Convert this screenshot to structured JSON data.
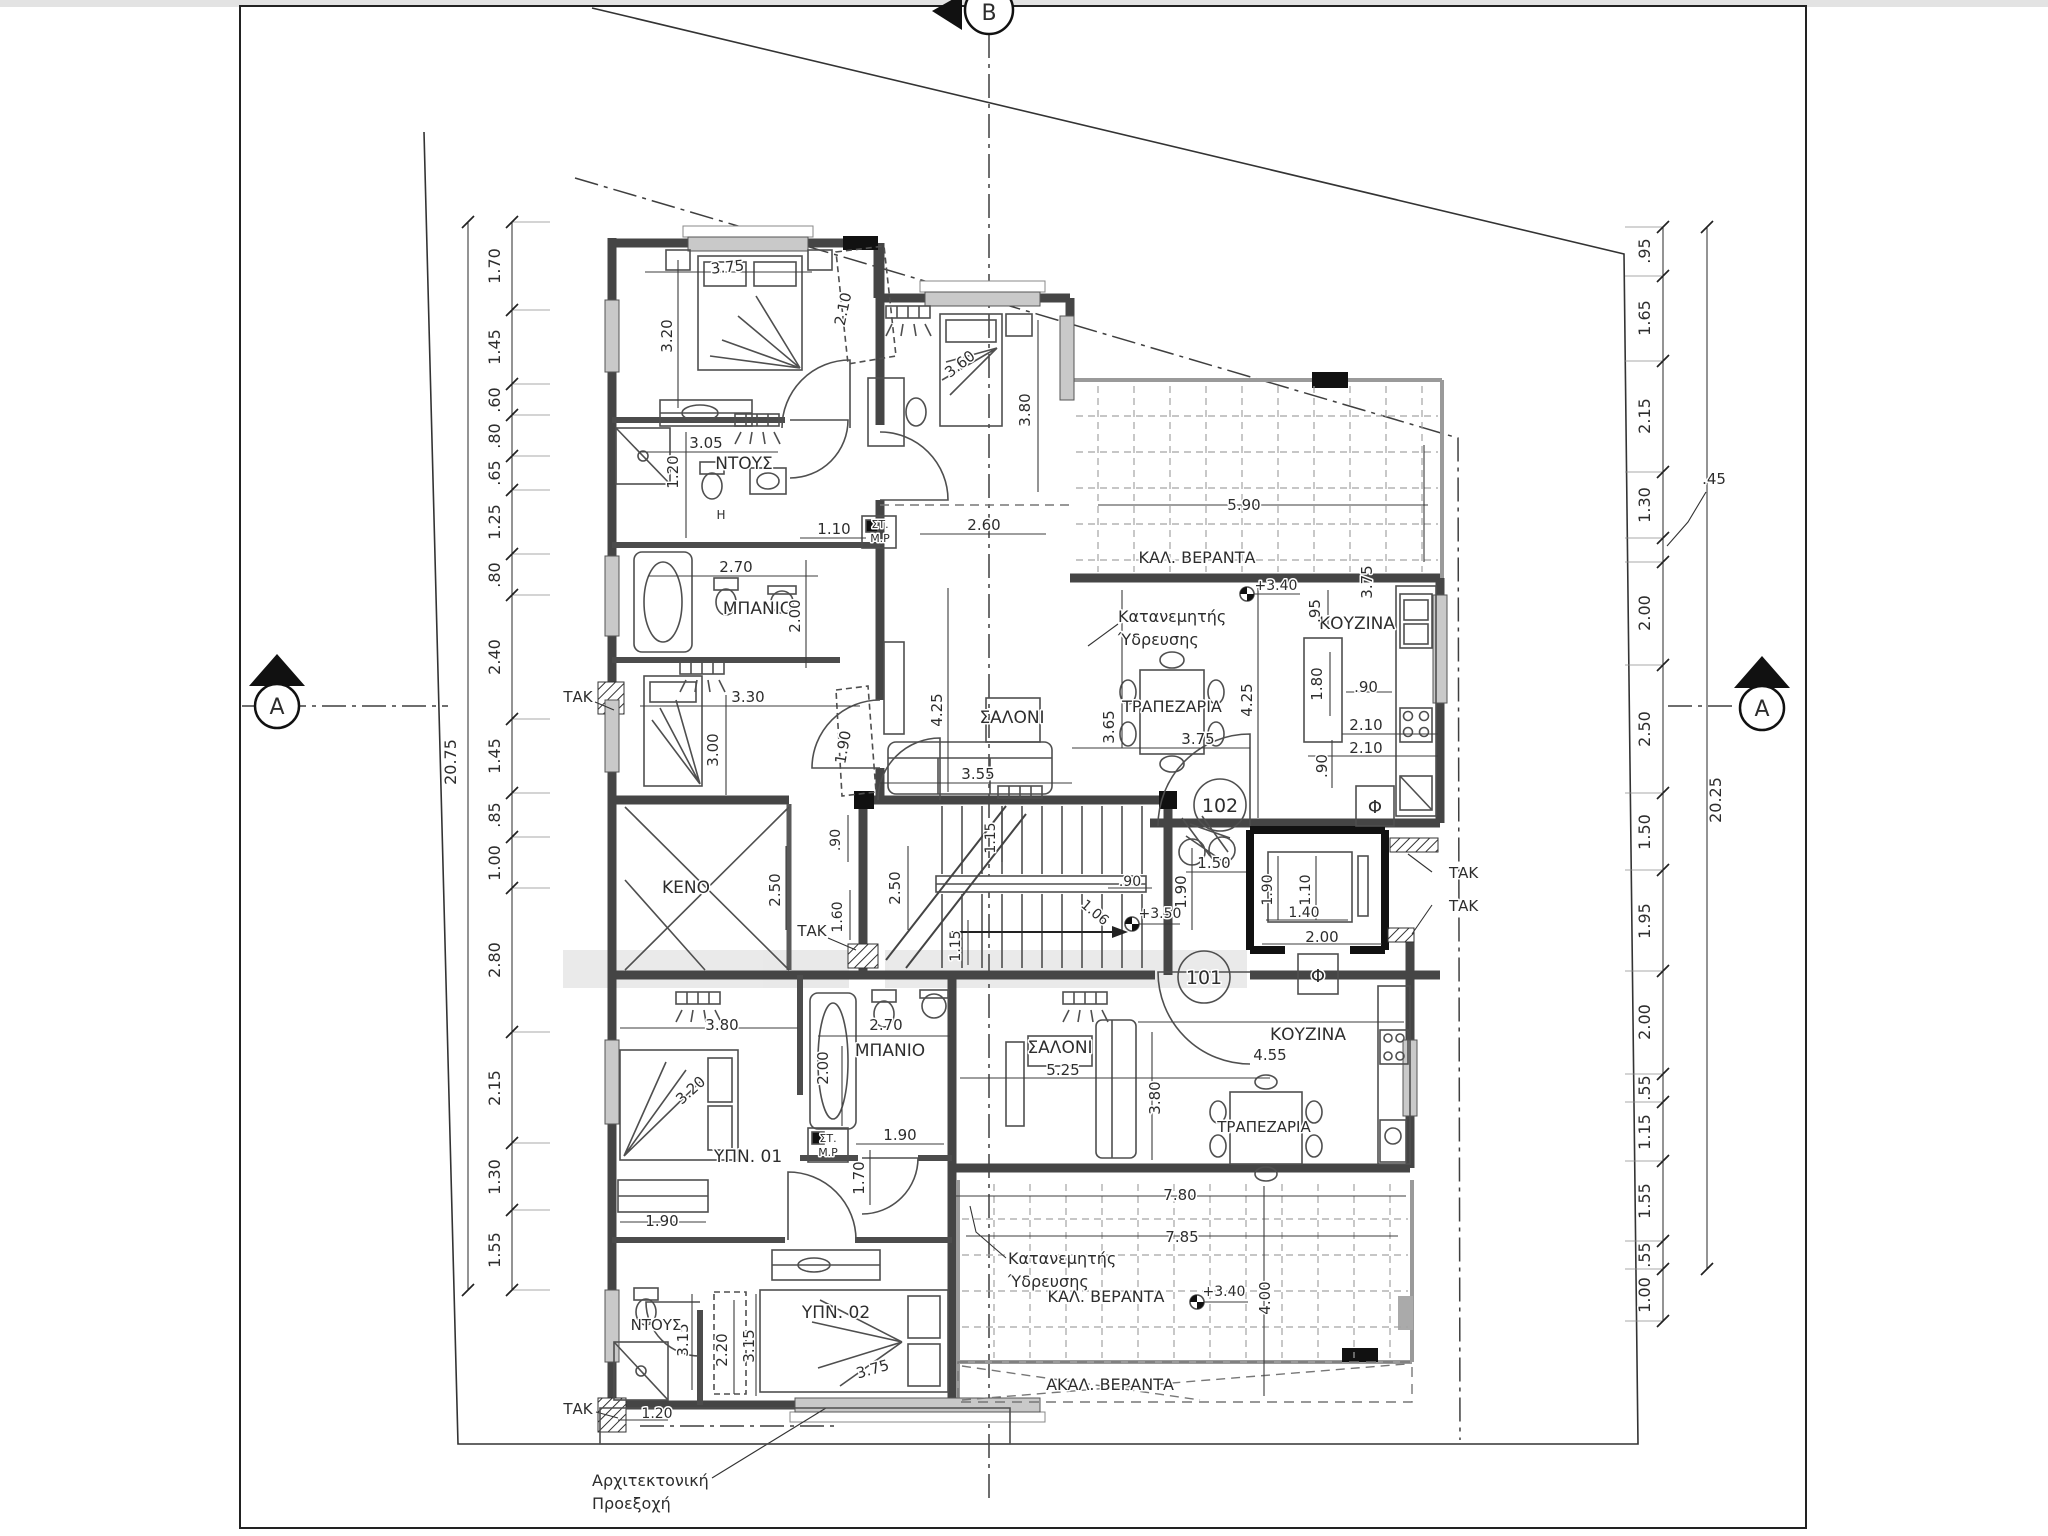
{
  "drawing_type": "architectural-floor-plan",
  "section_markers": {
    "top": "B",
    "left": "A",
    "right": "A"
  },
  "apartment_numbers": {
    "upper": "102",
    "lower": "101"
  },
  "colors": {
    "wall": "#454545",
    "black_column": "#111111",
    "text": "#2d2d2d",
    "window": "#c9c9c9",
    "paper": "#ffffff"
  },
  "overall_dims": {
    "left_total": "20.75",
    "right_total": "20.25"
  },
  "texts": [
    {
      "n": "dim-total-left",
      "t": "20.75",
      "x": 456,
      "y": 762,
      "r": -90,
      "s": 16
    },
    {
      "n": "dim-chain-left-1",
      "t": "1.70",
      "x": 500,
      "y": 266,
      "r": -90,
      "s": 16
    },
    {
      "n": "dim-chain-left-2",
      "t": "1.45",
      "x": 500,
      "y": 347,
      "r": -90,
      "s": 16
    },
    {
      "n": "dim-chain-left-3",
      "t": ".60",
      "x": 500,
      "y": 400,
      "r": -90,
      "s": 16
    },
    {
      "n": "dim-chain-left-4",
      "t": ".80",
      "x": 500,
      "y": 436,
      "r": -90,
      "s": 16
    },
    {
      "n": "dim-chain-left-5",
      "t": ".65",
      "x": 500,
      "y": 473,
      "r": -90,
      "s": 16
    },
    {
      "n": "dim-chain-left-6",
      "t": "1.25",
      "x": 500,
      "y": 522,
      "r": -90,
      "s": 16
    },
    {
      "n": "dim-chain-left-7",
      "t": ".80",
      "x": 500,
      "y": 575,
      "r": -90,
      "s": 16
    },
    {
      "n": "dim-chain-left-8",
      "t": "2.40",
      "x": 500,
      "y": 657,
      "r": -90,
      "s": 16
    },
    {
      "n": "dim-chain-left-9",
      "t": "1.45",
      "x": 500,
      "y": 756,
      "r": -90,
      "s": 16
    },
    {
      "n": "dim-chain-left-10",
      "t": ".85",
      "x": 500,
      "y": 815,
      "r": -90,
      "s": 16
    },
    {
      "n": "dim-chain-left-11",
      "t": "1.00",
      "x": 500,
      "y": 863,
      "r": -90,
      "s": 16
    },
    {
      "n": "dim-chain-left-12",
      "t": "2.80",
      "x": 500,
      "y": 960,
      "r": -90,
      "s": 16
    },
    {
      "n": "dim-chain-left-13",
      "t": "2.15",
      "x": 500,
      "y": 1088,
      "r": -90,
      "s": 16
    },
    {
      "n": "dim-chain-left-14",
      "t": "1.30",
      "x": 500,
      "y": 1177,
      "r": -90,
      "s": 16
    },
    {
      "n": "dim-chain-left-15",
      "t": "1.55",
      "x": 500,
      "y": 1250,
      "r": -90,
      "s": 16
    },
    {
      "n": "dim-total-right",
      "t": "20.25",
      "x": 1721,
      "y": 800,
      "r": -90,
      "s": 16
    },
    {
      "n": "dim-chain-right-1",
      "t": ".95",
      "x": 1650,
      "y": 251,
      "r": -90,
      "s": 16
    },
    {
      "n": "dim-chain-right-2",
      "t": "1.65",
      "x": 1650,
      "y": 318,
      "r": -90,
      "s": 16
    },
    {
      "n": "dim-chain-right-3",
      "t": "2.15",
      "x": 1650,
      "y": 416,
      "r": -90,
      "s": 16
    },
    {
      "n": "dim-chain-right-4",
      "t": "1.30",
      "x": 1650,
      "y": 505,
      "r": -90,
      "s": 16
    },
    {
      "n": "dim-chain-right-5",
      "t": ".45",
      "x": 1714,
      "y": 484,
      "r": 0,
      "s": 15
    },
    {
      "n": "dim-chain-right-6",
      "t": "2.00",
      "x": 1650,
      "y": 613,
      "r": -90,
      "s": 16
    },
    {
      "n": "dim-chain-right-7",
      "t": "2.50",
      "x": 1650,
      "y": 729,
      "r": -90,
      "s": 16
    },
    {
      "n": "dim-chain-right-8",
      "t": "1.50",
      "x": 1650,
      "y": 832,
      "r": -90,
      "s": 16
    },
    {
      "n": "dim-chain-right-9",
      "t": "1.95",
      "x": 1650,
      "y": 921,
      "r": -90,
      "s": 16
    },
    {
      "n": "dim-chain-right-10",
      "t": "2.00",
      "x": 1650,
      "y": 1022,
      "r": -90,
      "s": 16
    },
    {
      "n": "dim-chain-right-11",
      "t": ".55",
      "x": 1650,
      "y": 1088,
      "r": -90,
      "s": 16
    },
    {
      "n": "dim-chain-right-12",
      "t": "1.15",
      "x": 1650,
      "y": 1132,
      "r": -90,
      "s": 16
    },
    {
      "n": "dim-chain-right-13",
      "t": "1.55",
      "x": 1650,
      "y": 1201,
      "r": -90,
      "s": 16
    },
    {
      "n": "dim-chain-right-14",
      "t": ".55",
      "x": 1650,
      "y": 1255,
      "r": -90,
      "s": 16
    },
    {
      "n": "dim-chain-right-15",
      "t": "1.00",
      "x": 1650,
      "y": 1295,
      "r": -90,
      "s": 16
    },
    {
      "n": "room-label-shower-102",
      "t": "ΝΤΟΥΣ",
      "x": 744,
      "y": 469,
      "r": 0,
      "s": 17
    },
    {
      "n": "dim-shower-width",
      "t": "3.05",
      "x": 706,
      "y": 448,
      "r": 0,
      "s": 15
    },
    {
      "n": "dim-shower-depth",
      "t": "1.20",
      "x": 678,
      "y": 472,
      "r": -90,
      "s": 15
    },
    {
      "n": "label-h-boiler",
      "t": "H",
      "x": 721,
      "y": 519,
      "r": 0,
      "s": 12
    },
    {
      "n": "room-label-bath-102",
      "t": "ΜΠΑΝΙΟ",
      "x": 758,
      "y": 614,
      "r": 0,
      "s": 17
    },
    {
      "n": "dim-bath102-width",
      "t": "2.70",
      "x": 736,
      "y": 572,
      "r": 0,
      "s": 15
    },
    {
      "n": "dim-bath102-depth",
      "t": "2.00",
      "x": 800,
      "y": 616,
      "r": -90,
      "s": 15
    },
    {
      "n": "dim-bed1-width",
      "t": "3.75",
      "x": 728,
      "y": 272,
      "r": -6,
      "s": 15
    },
    {
      "n": "dim-bed1-height",
      "t": "3.20",
      "x": 672,
      "y": 336,
      "r": -90,
      "s": 15
    },
    {
      "n": "dim-bed1-wardrobe",
      "t": "2.10",
      "x": 848,
      "y": 310,
      "r": -78,
      "s": 15
    },
    {
      "n": "dim-bed2-diag",
      "t": "3.60",
      "x": 963,
      "y": 368,
      "r": -38,
      "s": 15
    },
    {
      "n": "dim-bed2-height",
      "t": "3.80",
      "x": 1030,
      "y": 410,
      "r": -90,
      "s": 15
    },
    {
      "n": "dim-bed3-width",
      "t": "3.30",
      "x": 748,
      "y": 702,
      "r": 0,
      "s": 15
    },
    {
      "n": "dim-bed3-height",
      "t": "3.00",
      "x": 718,
      "y": 750,
      "r": -90,
      "s": 15
    },
    {
      "n": "dim-bed3-wardrobe",
      "t": "1.90",
      "x": 848,
      "y": 748,
      "r": -80,
      "s": 15
    },
    {
      "n": "dim-corridor-110",
      "t": "1.10",
      "x": 834,
      "y": 534,
      "r": 0,
      "s": 15
    },
    {
      "n": "dim-corridor-260",
      "t": "2.60",
      "x": 984,
      "y": 530,
      "r": 0,
      "s": 15
    },
    {
      "n": "label-st-box-up",
      "t": "ΣΤ.",
      "x": 880,
      "y": 528,
      "r": 0,
      "s": 11
    },
    {
      "n": "label-mp-box-up",
      "t": "Μ.Ρ",
      "x": 880,
      "y": 542,
      "r": 0,
      "s": 11
    },
    {
      "n": "room-label-living-102",
      "t": "ΣΑΛΟΝΙ",
      "x": 1012,
      "y": 723,
      "r": 0,
      "s": 17
    },
    {
      "n": "dim-living102-355",
      "t": "3.55",
      "x": 978,
      "y": 779,
      "r": 0,
      "s": 15
    },
    {
      "n": "dim-living102-425",
      "t": "4.25",
      "x": 942,
      "y": 710,
      "r": -90,
      "s": 15
    },
    {
      "n": "room-label-dining-102",
      "t": "ΤΡΑΠΕΖΑΡΙΑ",
      "x": 1172,
      "y": 712,
      "r": 0,
      "s": 16
    },
    {
      "n": "dim-dining102-365",
      "t": "3.65",
      "x": 1114,
      "y": 727,
      "r": -90,
      "s": 15
    },
    {
      "n": "dim-dining102-375",
      "t": "3.75",
      "x": 1198,
      "y": 744,
      "r": 0,
      "s": 15
    },
    {
      "n": "dim-kitchen102-425",
      "t": "4.25",
      "x": 1252,
      "y": 700,
      "r": -90,
      "s": 15
    },
    {
      "n": "room-label-kitchen-102",
      "t": "ΚΟΥΖΙΝΑ",
      "x": 1357,
      "y": 629,
      "r": 0,
      "s": 17
    },
    {
      "n": "dim-kitchen102-095",
      "t": ".95",
      "x": 1320,
      "y": 611,
      "r": -90,
      "s": 15
    },
    {
      "n": "dim-island-180",
      "t": "1.80",
      "x": 1322,
      "y": 684,
      "r": -90,
      "s": 15
    },
    {
      "n": "dim-island-090",
      "t": ".90",
      "x": 1366,
      "y": 692,
      "r": 0,
      "s": 15
    },
    {
      "n": "dim-kitchen102-210a",
      "t": "2.10",
      "x": 1366,
      "y": 730,
      "r": 0,
      "s": 15
    },
    {
      "n": "dim-kitchen102-210b",
      "t": "2.10",
      "x": 1366,
      "y": 753,
      "r": 0,
      "s": 15
    },
    {
      "n": "dim-kitchen102-090v",
      "t": ".90",
      "x": 1327,
      "y": 766,
      "r": -90,
      "s": 15
    },
    {
      "n": "label-shaft-phi-up",
      "t": "Φ",
      "x": 1375,
      "y": 813,
      "r": 0,
      "s": 18
    },
    {
      "n": "room-label-veranda-102",
      "t": "ΚΑΛ. ΒΕΡΑΝΤΑ",
      "x": 1197,
      "y": 563,
      "r": 0,
      "s": 16
    },
    {
      "n": "dim-veranda102-590",
      "t": "5.90",
      "x": 1244,
      "y": 510,
      "r": 0,
      "s": 15
    },
    {
      "n": "level-veranda102",
      "t": "+3.40",
      "x": 1276,
      "y": 590,
      "r": 0,
      "s": 14
    },
    {
      "n": "dim-veranda102-375",
      "t": "3.75",
      "x": 1372,
      "y": 582,
      "r": -90,
      "s": 15
    },
    {
      "n": "note-water-dist-up-1",
      "t": "Κατανεμητής",
      "x": 1118,
      "y": 622,
      "r": 0,
      "s": 16,
      "a": "start"
    },
    {
      "n": "note-water-dist-up-2",
      "t": "Ύδρευσης",
      "x": 1118,
      "y": 645,
      "r": 0,
      "s": 16,
      "a": "start"
    },
    {
      "n": "room-label-void",
      "t": "ΚΕΝΟ",
      "x": 686,
      "y": 893,
      "r": 0,
      "s": 17
    },
    {
      "n": "dim-void-250",
      "t": "2.50",
      "x": 780,
      "y": 890,
      "r": -90,
      "s": 15
    },
    {
      "n": "dim-closet-090",
      "t": ".90",
      "x": 840,
      "y": 840,
      "r": -90,
      "s": 14
    },
    {
      "n": "dim-closet-160",
      "t": "1.60",
      "x": 842,
      "y": 917,
      "r": -90,
      "s": 14
    },
    {
      "n": "note-tak-void",
      "t": "ΤΑΚ",
      "x": 812,
      "y": 936,
      "r": 0,
      "s": 15
    },
    {
      "n": "dim-stair-250",
      "t": "2.50",
      "x": 900,
      "y": 888,
      "r": -90,
      "s": 15
    },
    {
      "n": "dim-stair-115a",
      "t": "1.15",
      "x": 995,
      "y": 838,
      "r": -90,
      "s": 14
    },
    {
      "n": "dim-stair-115b",
      "t": "1.15",
      "x": 960,
      "y": 946,
      "r": -90,
      "s": 14
    },
    {
      "n": "dim-bike-090",
      "t": ".90",
      "x": 1130,
      "y": 886,
      "r": 0,
      "s": 14
    },
    {
      "n": "dim-hall-150",
      "t": "1.50",
      "x": 1214,
      "y": 868,
      "r": 0,
      "s": 15
    },
    {
      "n": "dim-hall-190",
      "t": "1.90",
      "x": 1186,
      "y": 892,
      "r": -90,
      "s": 15
    },
    {
      "n": "dim-lift-190",
      "t": "1.90",
      "x": 1272,
      "y": 890,
      "r": -90,
      "s": 14
    },
    {
      "n": "dim-lift-110",
      "t": "1.10",
      "x": 1310,
      "y": 890,
      "r": -90,
      "s": 14
    },
    {
      "n": "dim-lift-140",
      "t": "1.40",
      "x": 1304,
      "y": 917,
      "r": 0,
      "s": 14
    },
    {
      "n": "dim-lift-200",
      "t": "2.00",
      "x": 1322,
      "y": 942,
      "r": 0,
      "s": 15
    },
    {
      "n": "level-landing",
      "t": "+3.50",
      "x": 1160,
      "y": 918,
      "r": 0,
      "s": 14
    },
    {
      "n": "dim-entry-106",
      "t": "1.06",
      "x": 1092,
      "y": 916,
      "r": 40,
      "s": 14
    },
    {
      "n": "apartment-number-102",
      "t": "102",
      "x": 1220,
      "y": 812,
      "r": 0,
      "s": 19
    },
    {
      "n": "apartment-number-101",
      "t": "101",
      "x": 1204,
      "y": 984,
      "r": 0,
      "s": 19
    },
    {
      "n": "label-shaft-phi-low",
      "t": "Φ",
      "x": 1318,
      "y": 982,
      "r": 0,
      "s": 18
    },
    {
      "n": "note-tak-right-1",
      "t": "ΤΑΚ",
      "x": 1449,
      "y": 878,
      "r": 0,
      "s": 15,
      "a": "start"
    },
    {
      "n": "note-tak-right-2",
      "t": "ΤΑΚ",
      "x": 1449,
      "y": 911,
      "r": 0,
      "s": 15,
      "a": "start"
    },
    {
      "n": "room-label-bath-101",
      "t": "ΜΠΑΝΙΟ",
      "x": 890,
      "y": 1056,
      "r": 0,
      "s": 17
    },
    {
      "n": "dim-bath101-270",
      "t": "2.70",
      "x": 886,
      "y": 1030,
      "r": 0,
      "s": 15
    },
    {
      "n": "dim-bath101-200",
      "t": "2.00",
      "x": 828,
      "y": 1068,
      "r": -90,
      "s": 15
    },
    {
      "n": "room-label-living-101",
      "t": "ΣΑΛΟΝΙ",
      "x": 1060,
      "y": 1053,
      "r": 0,
      "s": 17
    },
    {
      "n": "dim-living101-525",
      "t": "5.25",
      "x": 1063,
      "y": 1075,
      "r": 0,
      "s": 15
    },
    {
      "n": "dim-bed01-380",
      "t": "3.80",
      "x": 722,
      "y": 1030,
      "r": 0,
      "s": 15
    },
    {
      "n": "room-label-bed01",
      "t": "ΥΠΝ. 01",
      "x": 748,
      "y": 1162,
      "r": 0,
      "s": 17
    },
    {
      "n": "dim-bed01-diag",
      "t": "3.20",
      "x": 694,
      "y": 1094,
      "r": -42,
      "s": 15
    },
    {
      "n": "dim-bed01-wardrobe",
      "t": "1.90",
      "x": 662,
      "y": 1226,
      "r": 0,
      "s": 15
    },
    {
      "n": "label-st-box-low",
      "t": "ΣΤ.",
      "x": 828,
      "y": 1142,
      "r": 0,
      "s": 11
    },
    {
      "n": "label-mp-box-low",
      "t": "Μ.Ρ",
      "x": 828,
      "y": 1156,
      "r": 0,
      "s": 11
    },
    {
      "n": "dim-hall101-190",
      "t": "1.90",
      "x": 900,
      "y": 1140,
      "r": 0,
      "s": 15
    },
    {
      "n": "dim-hall101-170",
      "t": "1.70",
      "x": 864,
      "y": 1178,
      "r": -90,
      "s": 15
    },
    {
      "n": "room-label-bed02",
      "t": "ΥΠΝ. 02",
      "x": 836,
      "y": 1318,
      "r": 0,
      "s": 17
    },
    {
      "n": "dim-bed02-315a",
      "t": "3.15",
      "x": 754,
      "y": 1346,
      "r": -90,
      "s": 15
    },
    {
      "n": "dim-bed02-220",
      "t": "2.20",
      "x": 727,
      "y": 1350,
      "r": -90,
      "s": 15
    },
    {
      "n": "dim-bed02-315b",
      "t": "3.15",
      "x": 688,
      "y": 1340,
      "r": -90,
      "s": 15
    },
    {
      "n": "dim-bed02-diag",
      "t": "3.75",
      "x": 874,
      "y": 1374,
      "r": -16,
      "s": 15
    },
    {
      "n": "room-label-shower-101",
      "t": "ΝΤΟΥΣ",
      "x": 656,
      "y": 1330,
      "r": 0,
      "s": 15
    },
    {
      "n": "dim-shower101-120",
      "t": "1.20",
      "x": 657,
      "y": 1418,
      "r": 0,
      "s": 14
    },
    {
      "n": "room-label-kitchen-101",
      "t": "ΚΟΥΖΙΝΑ",
      "x": 1308,
      "y": 1040,
      "r": 0,
      "s": 17
    },
    {
      "n": "dim-kitchen101-455",
      "t": "4.55",
      "x": 1270,
      "y": 1060,
      "r": 0,
      "s": 15
    },
    {
      "n": "room-label-dining-101",
      "t": "ΤΡΑΠΕΖΑΡΙΑ",
      "x": 1264,
      "y": 1132,
      "r": 0,
      "s": 15
    },
    {
      "n": "dim-living101-380",
      "t": "3.80",
      "x": 1160,
      "y": 1098,
      "r": -90,
      "s": 15
    },
    {
      "n": "dim-living101-780",
      "t": "7.80",
      "x": 1180,
      "y": 1200,
      "r": 0,
      "s": 15
    },
    {
      "n": "dim-veranda101-785",
      "t": "7.85",
      "x": 1182,
      "y": 1242,
      "r": 0,
      "s": 15
    },
    {
      "n": "room-label-veranda-101",
      "t": "ΚΑΛ. ΒΕΡΑΝΤΑ",
      "x": 1106,
      "y": 1302,
      "r": 0,
      "s": 16
    },
    {
      "n": "level-veranda101",
      "t": "+3.40",
      "x": 1224,
      "y": 1296,
      "r": 0,
      "s": 14
    },
    {
      "n": "dim-veranda101-400",
      "t": "4.00",
      "x": 1270,
      "y": 1298,
      "r": -90,
      "s": 15
    },
    {
      "n": "note-water-dist-low-1",
      "t": "Κατανεμητής",
      "x": 1008,
      "y": 1264,
      "r": 0,
      "s": 16,
      "a": "start"
    },
    {
      "n": "note-water-dist-low-2",
      "t": "Ύδρευσης",
      "x": 1008,
      "y": 1287,
      "r": 0,
      "s": 16,
      "a": "start"
    },
    {
      "n": "room-label-veranda-uncov",
      "t": "ΑΚΑΛ. ΒΕΡΑΝΤΑ",
      "x": 1110,
      "y": 1390,
      "r": 0,
      "s": 16
    },
    {
      "n": "note-tak-bottom",
      "t": "ΤΑΚ",
      "x": 578,
      "y": 1414,
      "r": 0,
      "s": 15
    },
    {
      "n": "note-tak-left",
      "t": "ΤΑΚ",
      "x": 578,
      "y": 702,
      "r": 0,
      "s": 15
    },
    {
      "n": "note-arch-projection-1",
      "t": "Αρχιτεκτονική",
      "x": 592,
      "y": 1486,
      "r": 0,
      "s": 16,
      "a": "start"
    },
    {
      "n": "note-arch-projection-2",
      "t": "Προεξοχή",
      "x": 592,
      "y": 1509,
      "r": 0,
      "s": 16,
      "a": "start"
    }
  ]
}
